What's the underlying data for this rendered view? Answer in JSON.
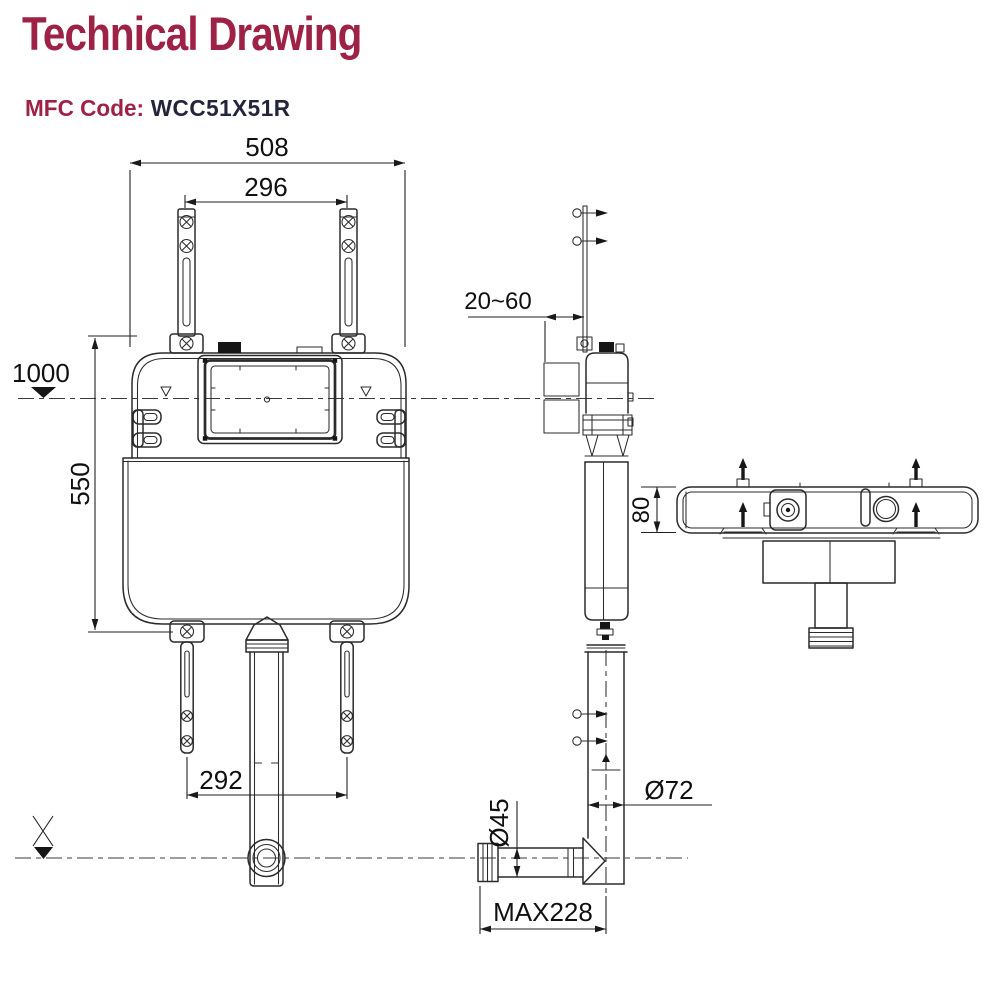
{
  "header": {
    "title": "Technical Drawing",
    "mfc_label": "MFC Code:",
    "mfc_code": "WCC51X51R"
  },
  "colors": {
    "accent": "#9e2246",
    "code_text": "#23253a",
    "line_color": "#2b2b2b",
    "background": "#ffffff"
  },
  "drawing": {
    "dims": {
      "front_width": "508",
      "hanger_spacing": "296",
      "datum_height": "1000",
      "tank_height": "550",
      "leg_spacing": "292",
      "wall_clearance_range": "20~60",
      "body_depth": "80",
      "flush_pipe_diameter": "Ø72",
      "outlet_diameter": "Ø45",
      "outlet_max_length": "MAX228"
    }
  }
}
